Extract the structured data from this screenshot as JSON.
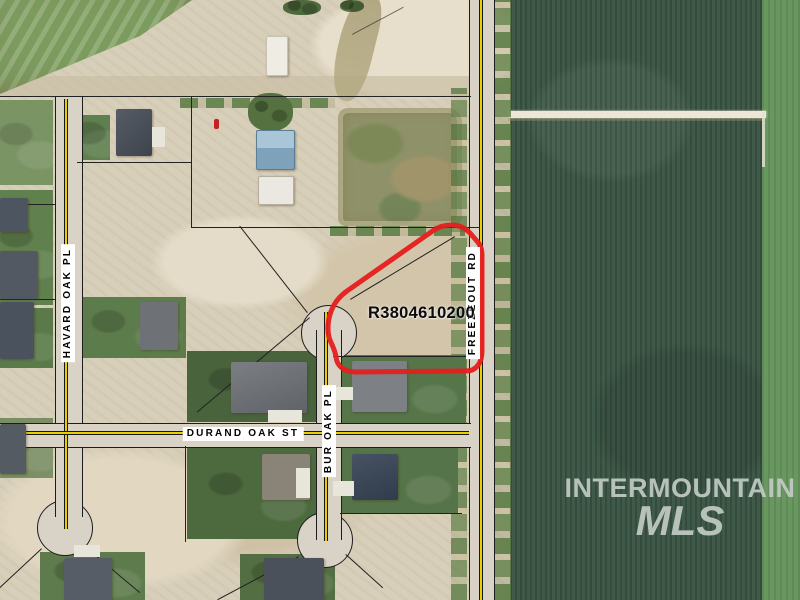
{
  "map": {
    "parcel_id": "R3804610200",
    "streets": {
      "havard": "HAVARD OAK PL",
      "durand": "DURAND OAK ST",
      "bur_oak": "BUR OAK PL",
      "freezeout": "FREEZEOUT RD"
    },
    "watermark": {
      "line1": "INTERMOUNTAIN",
      "line2": "MLS"
    },
    "colors": {
      "parcel_outline_red": "#e61d1d",
      "field_dark_green": "#3f5a49",
      "field_light_green": "#68975f",
      "dirt_beige": "#d8cfba",
      "road_pavement": "#d8d3c6",
      "centerline_yellow": "#e8cf00",
      "watermark_gray": "#c2cbc5",
      "label_background": "#ffffff"
    }
  }
}
